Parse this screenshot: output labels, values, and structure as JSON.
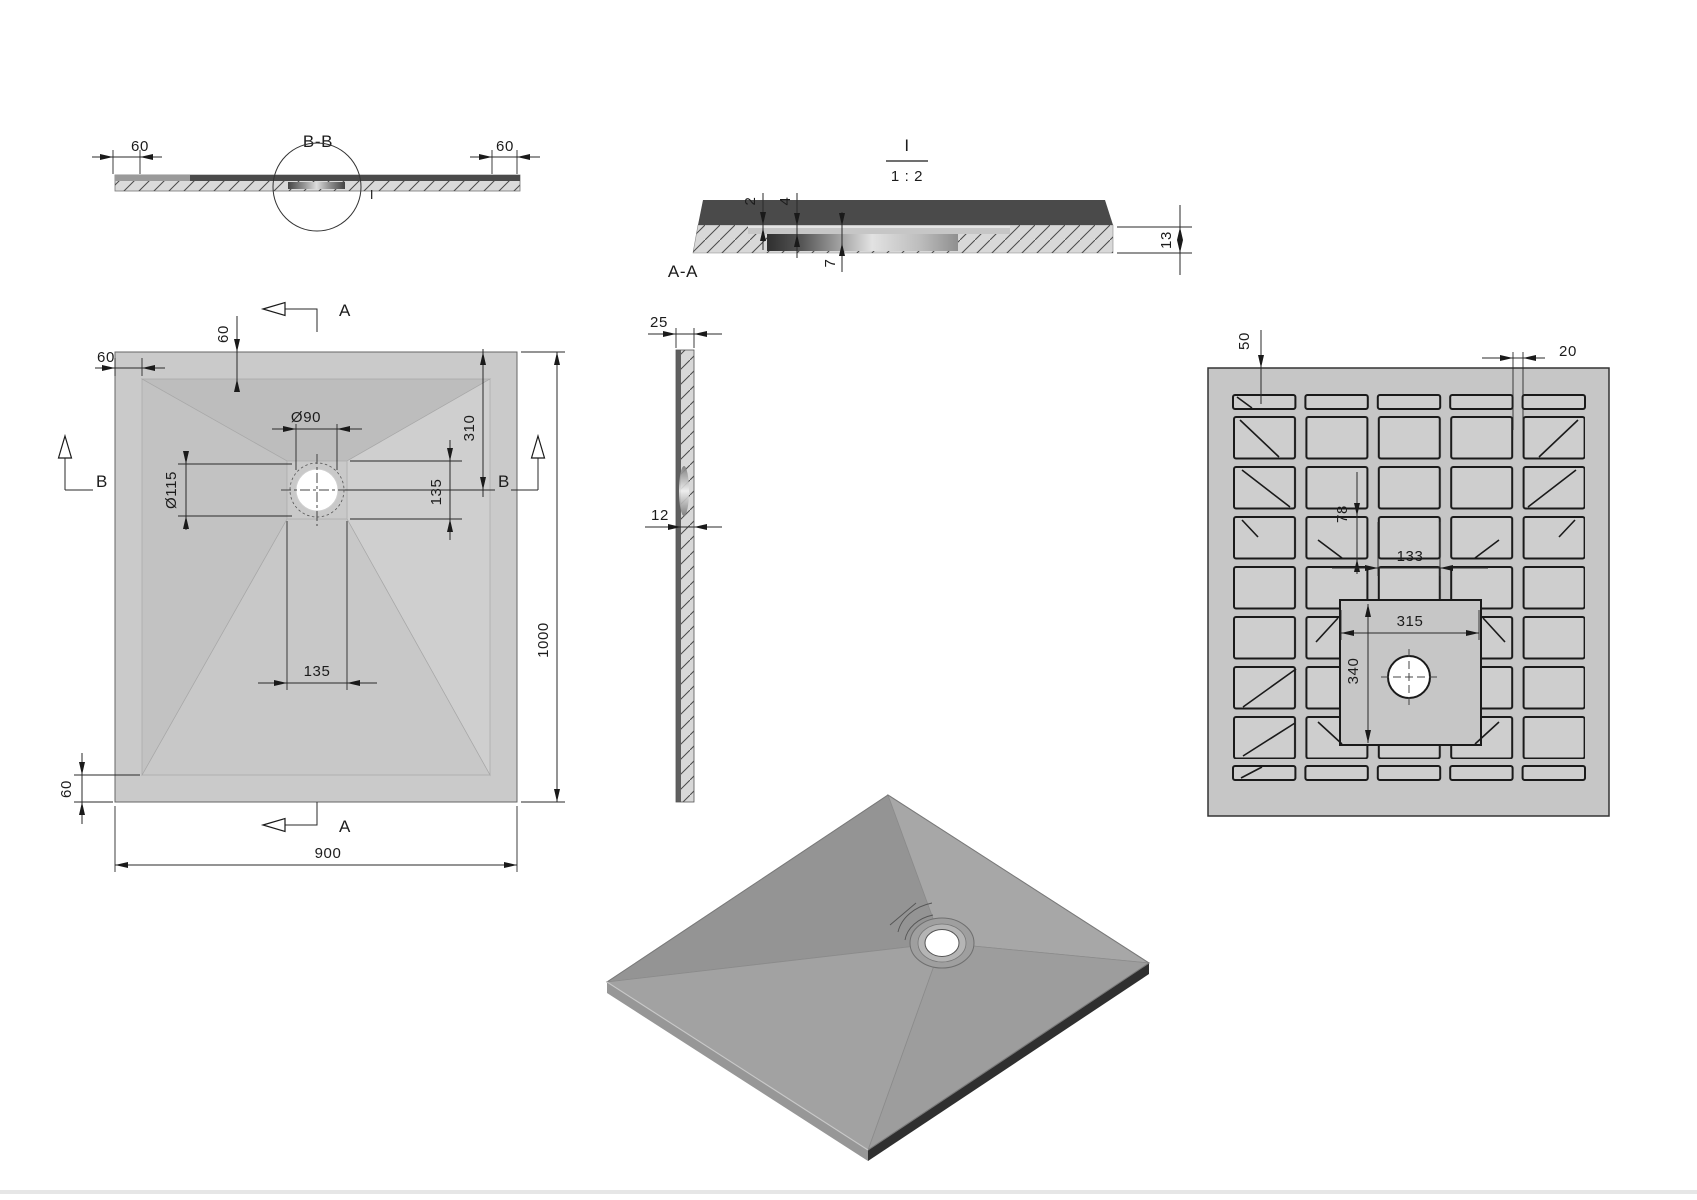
{
  "views": {
    "section_bb": {
      "name": "B-B",
      "detail_mark": "I",
      "dim_rim_left": "60",
      "dim_rim_right": "60"
    },
    "detail_i": {
      "mark": "I",
      "scale": "1 : 2",
      "section_name": "A-A",
      "dim_step_2": "2",
      "dim_step_4": "4",
      "dim_step_7": "7",
      "dim_thickness_13": "13"
    },
    "side": {
      "dim_top": "25",
      "dim_mid": "12"
    },
    "plan": {
      "marker_a": "A",
      "marker_b": "B",
      "dim_rim_left": "60",
      "dim_rim_top": "60",
      "dim_rim_bottom": "60",
      "dim_drain_dia": "Ø90",
      "dim_flange_dia": "Ø115",
      "dim_drain_from_top": "310",
      "dim_recess_v": "135",
      "dim_recess_h": "135",
      "dim_width": "900",
      "dim_length": "1000"
    },
    "bottom": {
      "dim_slot": "50",
      "dim_gap": "20",
      "dim_pocket_h": "78",
      "dim_pocket_w": "133",
      "dim_plateau_w": "315",
      "dim_plateau_h": "340"
    }
  },
  "colors": {
    "tray_gray": "#c6c6c6",
    "pocket_gray": "#cecece",
    "dark_band": "#4a4a4a",
    "hatch_fill": "#d8d8d8",
    "line": "#1a1a1a"
  }
}
